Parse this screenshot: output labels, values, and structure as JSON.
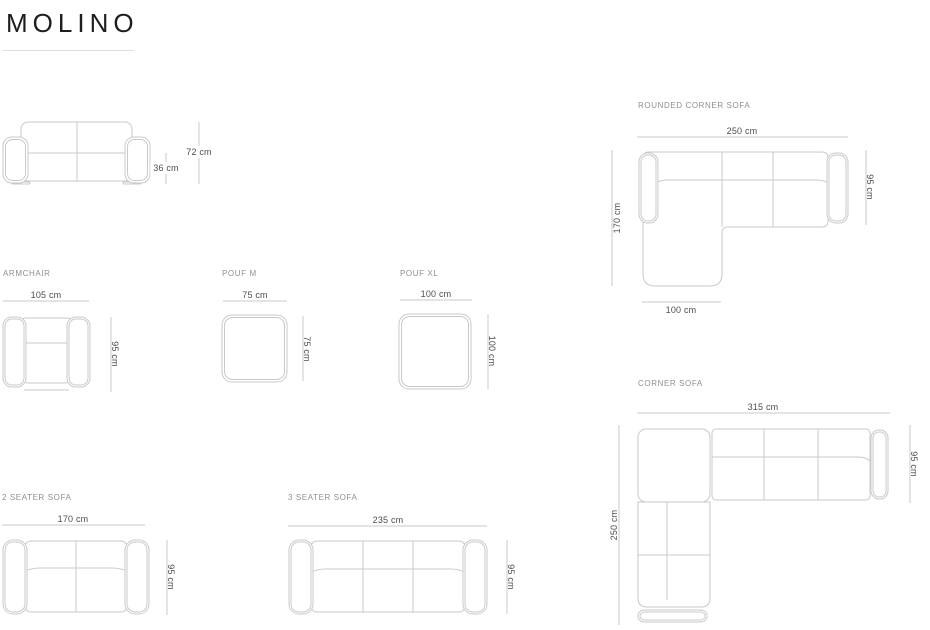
{
  "page": {
    "title": "MOLINO"
  },
  "colors": {
    "line": "#c9c9c9",
    "dim_text": "#4d4d4d",
    "label_text": "#8f8f8f",
    "title": "#1e1e1e",
    "rule": "#dedede"
  },
  "diagrams": {
    "sofa_front": {
      "dims": {
        "total_height": "72 cm",
        "seat_height": "36 cm"
      }
    },
    "rounded_corner_sofa": {
      "label": "ROUNDED CORNER SOFA",
      "dims": {
        "width": "250 cm",
        "depth": "95 cm",
        "side_length": "170 cm",
        "chaise_width": "100 cm"
      }
    },
    "armchair": {
      "label": "ARMCHAIR",
      "dims": {
        "width": "105 cm",
        "depth": "95 cm"
      }
    },
    "pouf_m": {
      "label": "POUF M",
      "dims": {
        "width": "75 cm",
        "depth": "75 cm"
      }
    },
    "pouf_xl": {
      "label": "POUF XL",
      "dims": {
        "width": "100 cm",
        "depth": "100 cm"
      }
    },
    "corner_sofa": {
      "label": "CORNER SOFA",
      "dims": {
        "width": "315 cm",
        "depth": "95 cm",
        "side_length": "250 cm"
      }
    },
    "two_seater_sofa": {
      "label": "2 SEATER SOFA",
      "dims": {
        "width": "170 cm",
        "depth": "95 cm"
      }
    },
    "three_seater_sofa": {
      "label": "3 SEATER SOFA",
      "dims": {
        "width": "235 cm",
        "depth": "95 cm"
      }
    }
  }
}
